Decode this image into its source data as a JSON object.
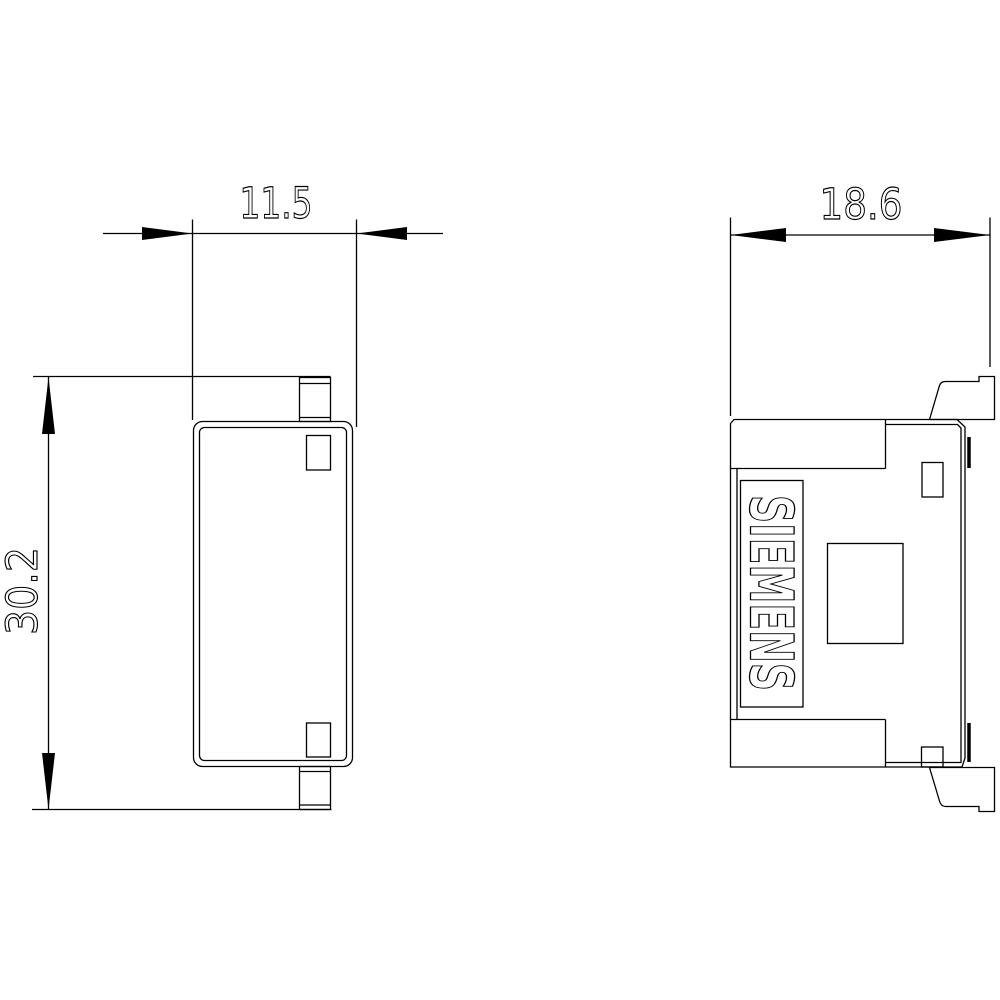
{
  "drawing": {
    "background_color": "#ffffff",
    "line_color": "#000000",
    "front_view": {
      "width_label": "11.5",
      "height_label": "30.2"
    },
    "side_view": {
      "width_label": "18.6",
      "brand_label": "SIEMENS"
    }
  }
}
